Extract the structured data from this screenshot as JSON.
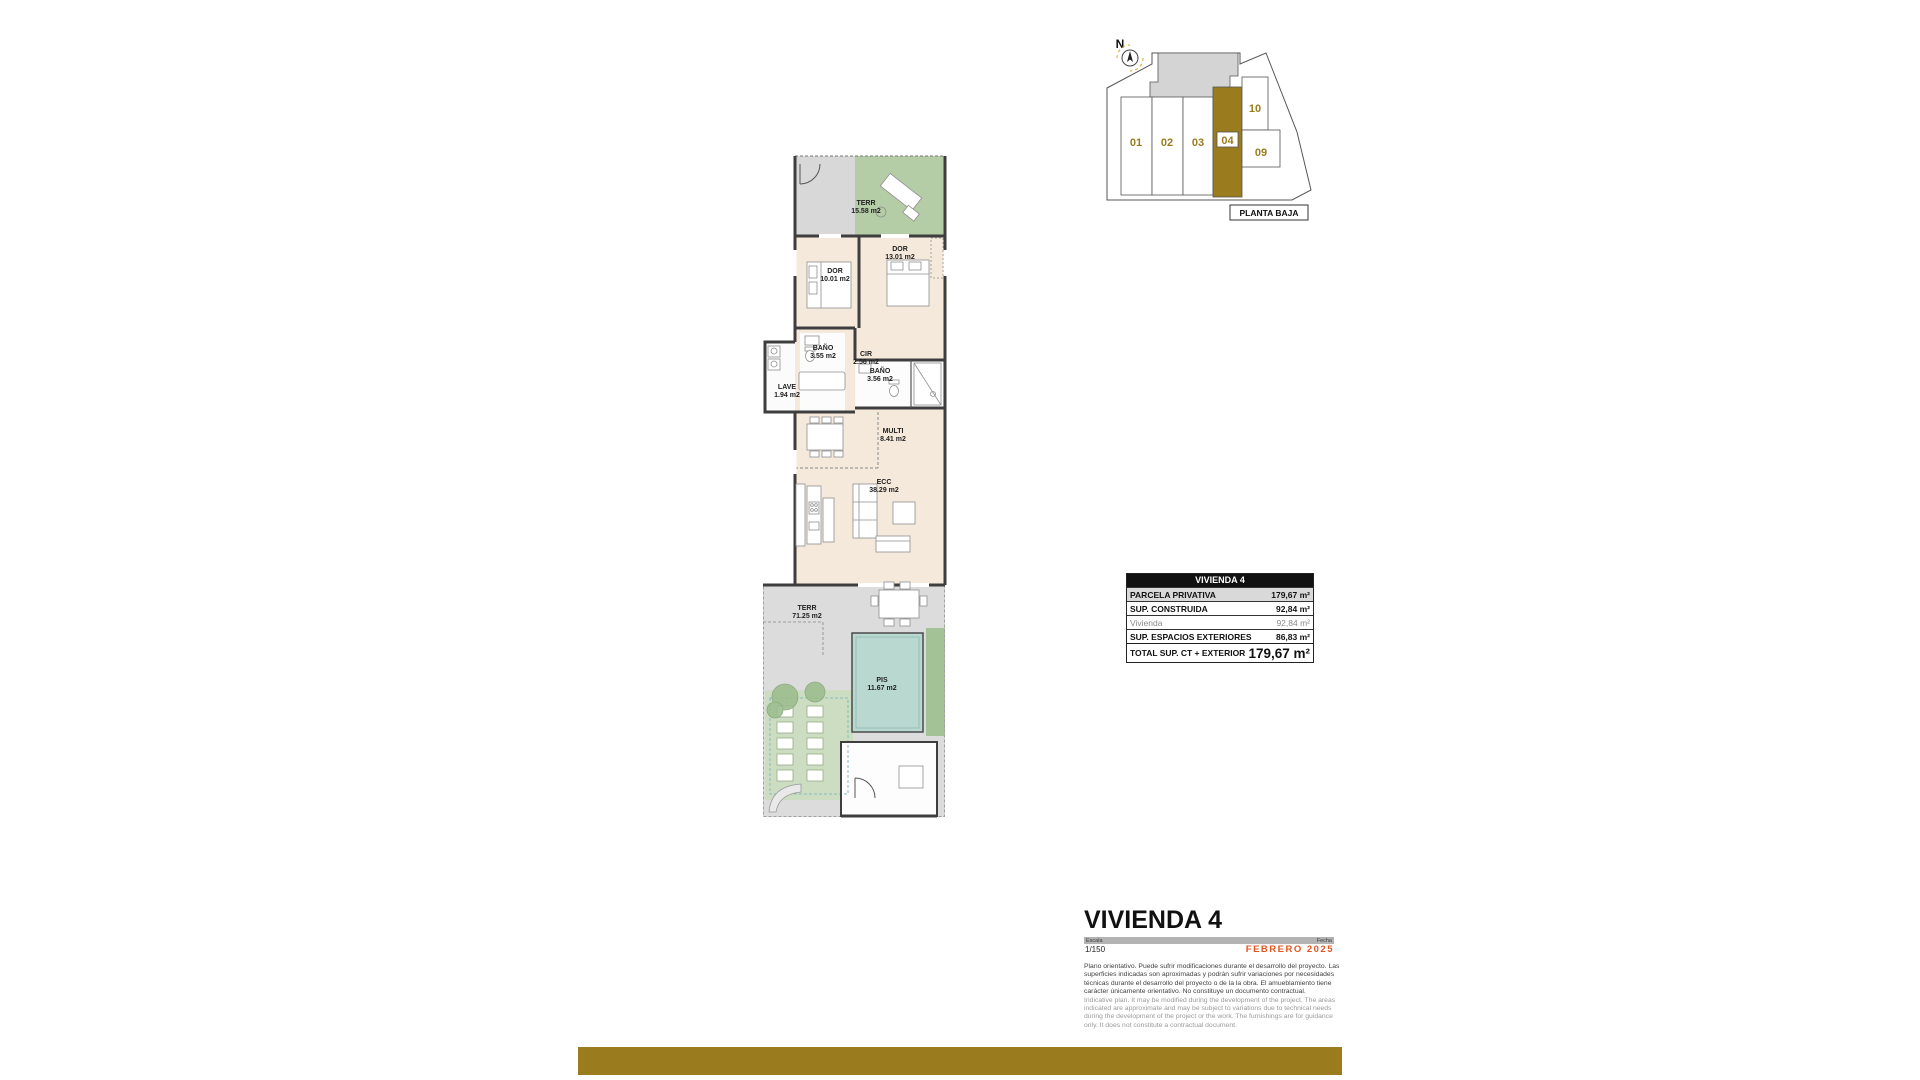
{
  "site_plan": {
    "north": "N",
    "units": [
      "01",
      "02",
      "03",
      "04",
      "09",
      "10"
    ],
    "highlighted_unit": "04",
    "caption": "PLANTA BAJA"
  },
  "floorplan": {
    "rooms": [
      {
        "name": "TERR",
        "area": "15.58 m2"
      },
      {
        "name": "DOR",
        "area": "13.01 m2"
      },
      {
        "name": "DOR",
        "area": "10.01 m2"
      },
      {
        "name": "BAÑO",
        "area": "3.55 m2"
      },
      {
        "name": "CIR",
        "area": "2.56 m2"
      },
      {
        "name": "LAVE",
        "area": "1.94 m2"
      },
      {
        "name": "BAÑO",
        "area": "3.56 m2"
      },
      {
        "name": "MULTI",
        "area": "8.41 m2"
      },
      {
        "name": "ECC",
        "area": "38.29 m2"
      },
      {
        "name": "TERR",
        "area": "71.25 m2"
      },
      {
        "name": "PIS",
        "area": "11.67 m2"
      }
    ]
  },
  "summary_table": {
    "title": "VIVIENDA 4",
    "rows": [
      {
        "label": "PARCELA PRIVATIVA",
        "value": "179,67 m²"
      },
      {
        "label": "SUP. CONSTRUIDA",
        "value": "92,84 m²"
      },
      {
        "label": "Vivienda",
        "value": "92,84 m²"
      },
      {
        "label": "SUP. ESPACIOS EXTERIORES",
        "value": "86,83 m²"
      },
      {
        "label": "TOTAL SUP. CT + EXTERIOR",
        "value": "179,67 m²"
      }
    ]
  },
  "title_block": {
    "title": "VIVIENDA 4",
    "scale_label": "Escala",
    "scale_value": "1/150",
    "date_label": "Fecha",
    "date_value": "FEBRERO 2025",
    "disclaimer_es": "Plano orientativo. Puede sufrir modificaciones durante el desarrollo del proyecto. Las superficies indicadas son aproximadas y podrán sufrir variaciones por necesidades técnicas durante el desarrollo del proyecto o de la la obra. El amueblamiento tiene carácter únicamente orientativo. No constituye un documento contractual.",
    "disclaimer_en": "Indicative plan. It may be modified during the development of the project. The areas indicated are approximate and may be subject to variations due to technical needs during the development of the project or the work. The furnishings are for guidance only. It does not constitute a contractual document."
  },
  "colors": {
    "accent_gold": "#9a7c1e",
    "date_orange": "#e2551f",
    "terrace_green": "#b5cda6",
    "pool_teal": "#b9d8d0",
    "interior_beige": "#f5e9dc"
  }
}
